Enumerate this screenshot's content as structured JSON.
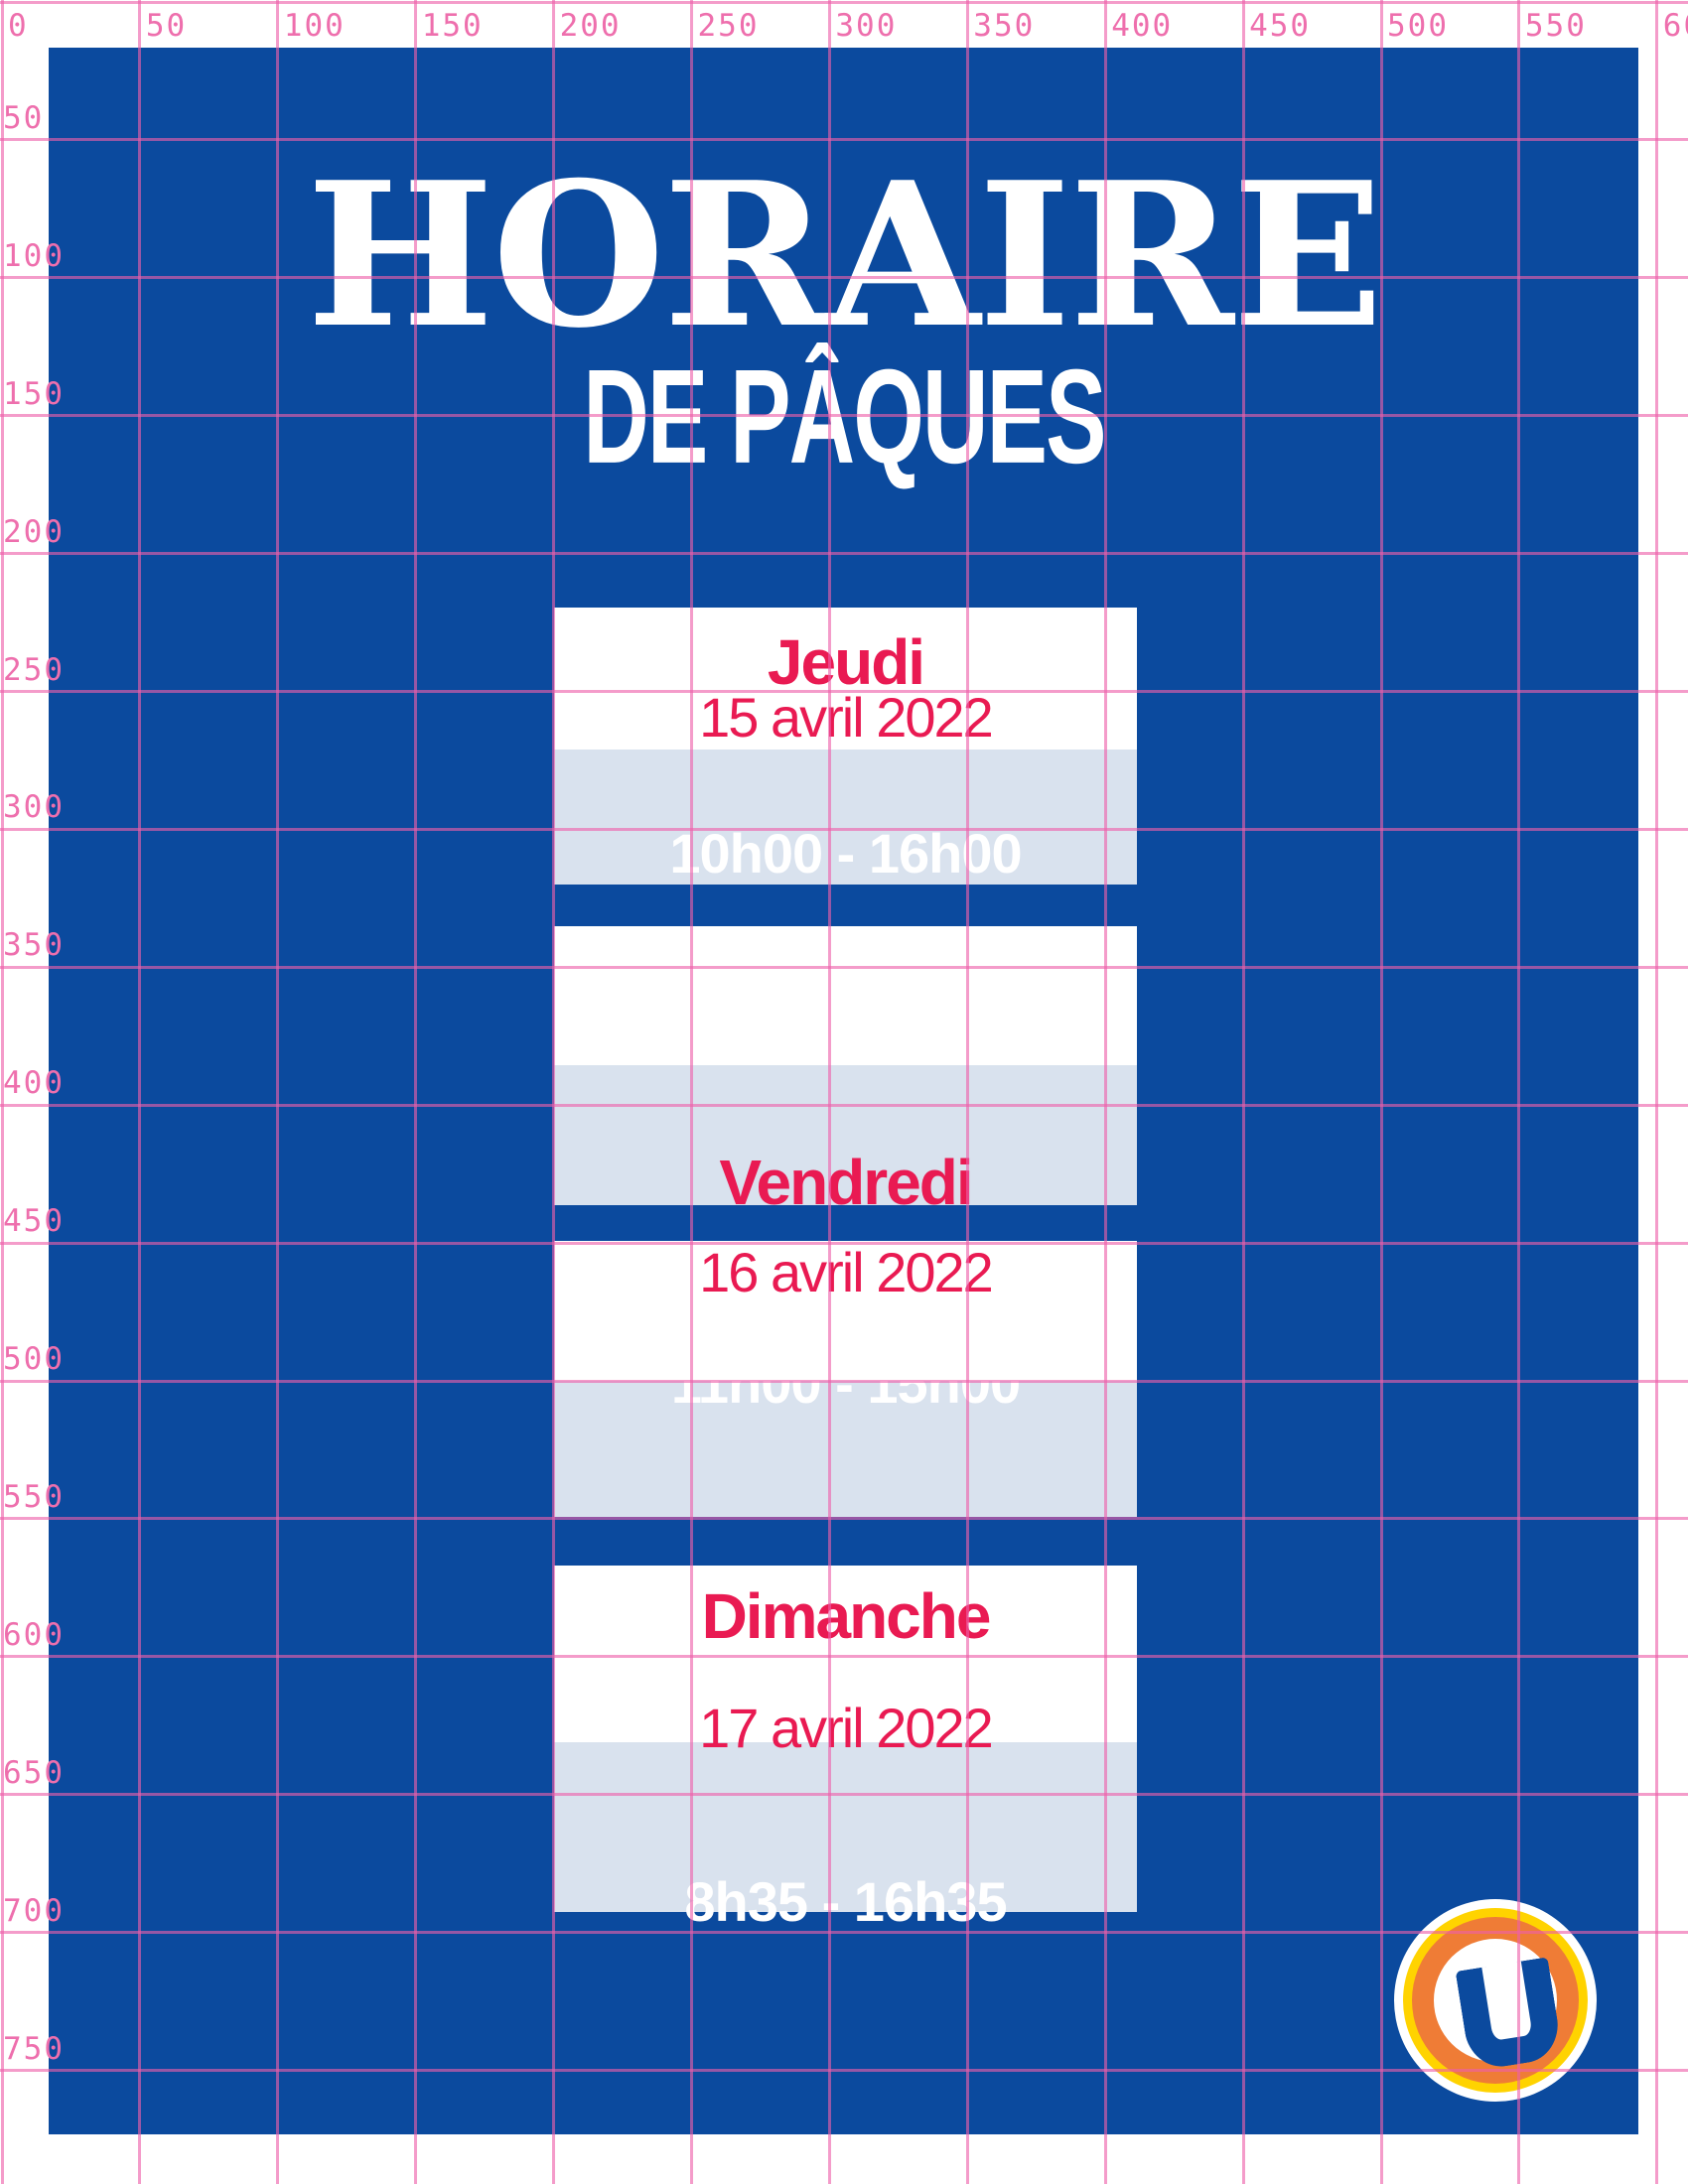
{
  "title": {
    "line1": "HORAIRE",
    "line2": "DE PÂQUES"
  },
  "schedule": [
    {
      "day": "Jeudi",
      "date": "15 avril 2022",
      "hours": "10h00 - 16h00"
    },
    {
      "day": "Vendredi",
      "date": "16 avril 2022",
      "hours": "11h00 - 15h00"
    },
    {
      "day": "Dimanche",
      "date": "17 avril 2022",
      "hours": "8h35 - 16h35"
    }
  ],
  "rulers": {
    "top": [
      "0",
      "50",
      "100",
      "150",
      "200",
      "250",
      "300",
      "350",
      "400",
      "450",
      "500",
      "550",
      "600"
    ],
    "left": [
      "50",
      "100",
      "150",
      "200",
      "250",
      "300",
      "350",
      "400",
      "450",
      "500",
      "550",
      "600",
      "650",
      "700",
      "750"
    ]
  },
  "logo": {
    "letter": "U"
  },
  "colors": {
    "blue": "#0b4a9e",
    "band": "#d9e2ee",
    "red": "#e91a52",
    "pink": "#ee6fad",
    "grid": "rgba(238,95,170,0.62)",
    "orange": "#ef7c36",
    "yellow": "#ffd300"
  }
}
